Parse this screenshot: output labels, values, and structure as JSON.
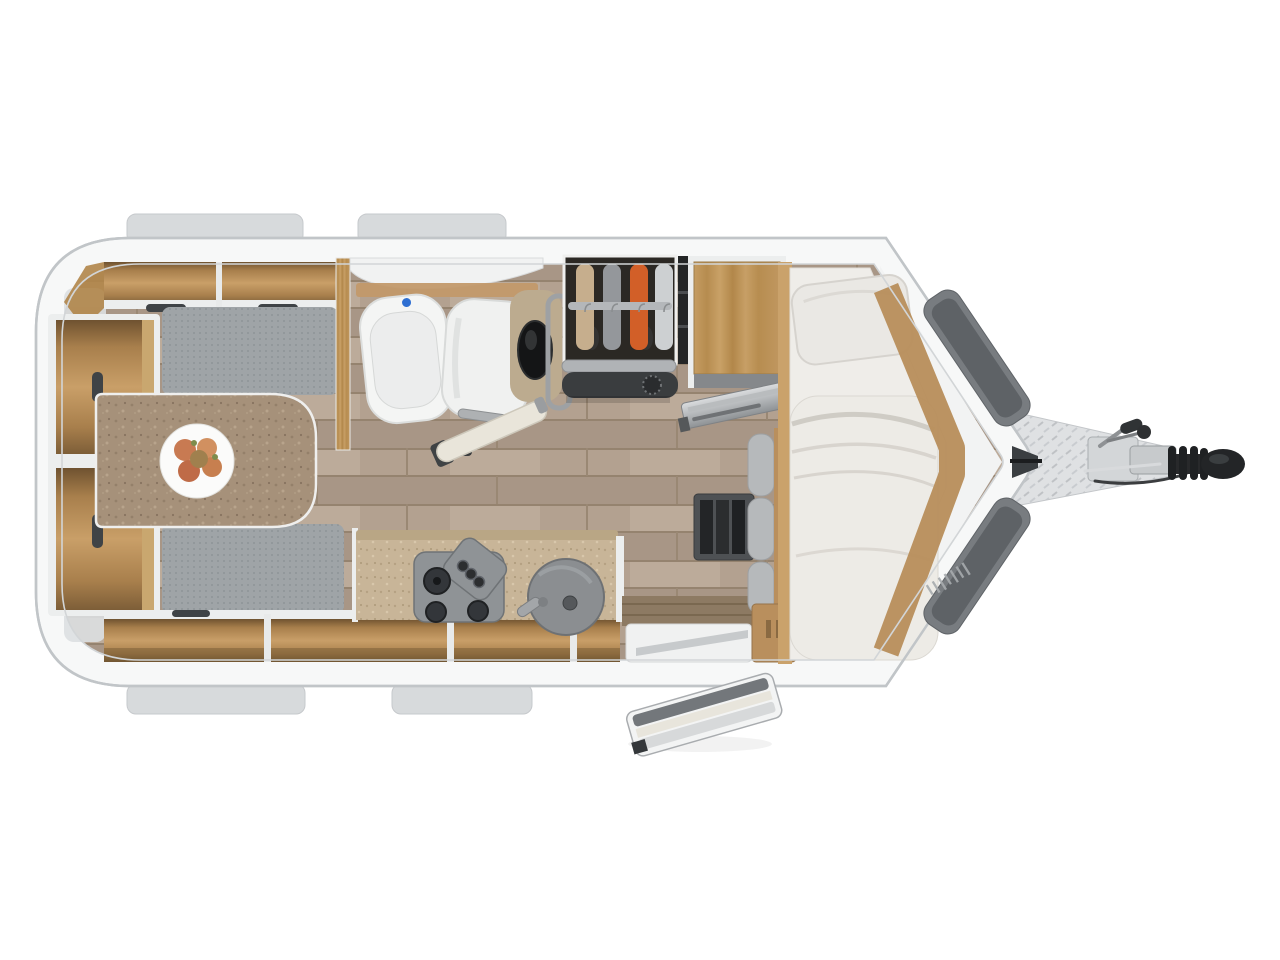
{
  "scene": {
    "description": "Top-down 3D rendered floor plan of a single-axle travel trailer caravan with hitch drawbar pointing right",
    "areas": [
      "front-dinette-with-table-and-benches",
      "bathroom-with-toilet-shower-and-corner-basin",
      "wardrobe-with-hanging-clothes",
      "fridge-cabinet-with-open-door",
      "kitchen-with-hob-and-round-sink",
      "entry-with-open-door-and-step",
      "rear-single-bed-with-pillow-and-duvet",
      "v-shaped-nose-with-drawbar-hitch"
    ],
    "icons": [
      "fruit-plate-icon",
      "toilet-icon",
      "shower-icon",
      "washbasin-icon",
      "clothes-hanger-icon",
      "hob-burner-icon",
      "sink-drain-icon",
      "heater-dial-icon",
      "coupling-head-icon"
    ]
  },
  "colors": {
    "background": "#ffffff",
    "shell": "#f7f8f8",
    "shell_outline": "#c1c5c8",
    "shell_inner_line": "#d2d5d7",
    "window_tab": "#d7dadc",
    "floor_wood": "#b3a190",
    "furniture_wood": "#b98f5d",
    "wood_dark": "#8a6a42",
    "white_edge": "#eceeee",
    "cushion_gray": "#9fa4a7",
    "table_brown": "#a6917a",
    "counter_beige": "#c8b598",
    "mattress_white": "#efede9",
    "bedding_white": "#edebe6",
    "pillow_white": "#eae8e4",
    "bathroom_white": "#f4f5f4",
    "flush_button_blue": "#2e6fd2",
    "vanity_beige": "#bcab8f",
    "basin_black": "#141516",
    "wardrobe_interior": "#2b2824",
    "clothes_tan": "#c6ae8d",
    "clothes_gray": "#94979b",
    "clothes_orange": "#d25f28",
    "clothes_white": "#cdd0d2",
    "rail_gray": "#b4b7ba",
    "heater_dark": "#3a3d3f",
    "hob_gray": "#8f9396",
    "burner_black": "#33363a",
    "sink_gray": "#8b8e91",
    "step_white": "#f0f1f1",
    "door_cream": "#e9e5da",
    "trim_dark_gray": "#6b6f73",
    "trim_darker": "#5e6266",
    "treadplate": "#dfe1e3",
    "hitch_black": "#232527",
    "handle_dark": "#3f4346"
  }
}
